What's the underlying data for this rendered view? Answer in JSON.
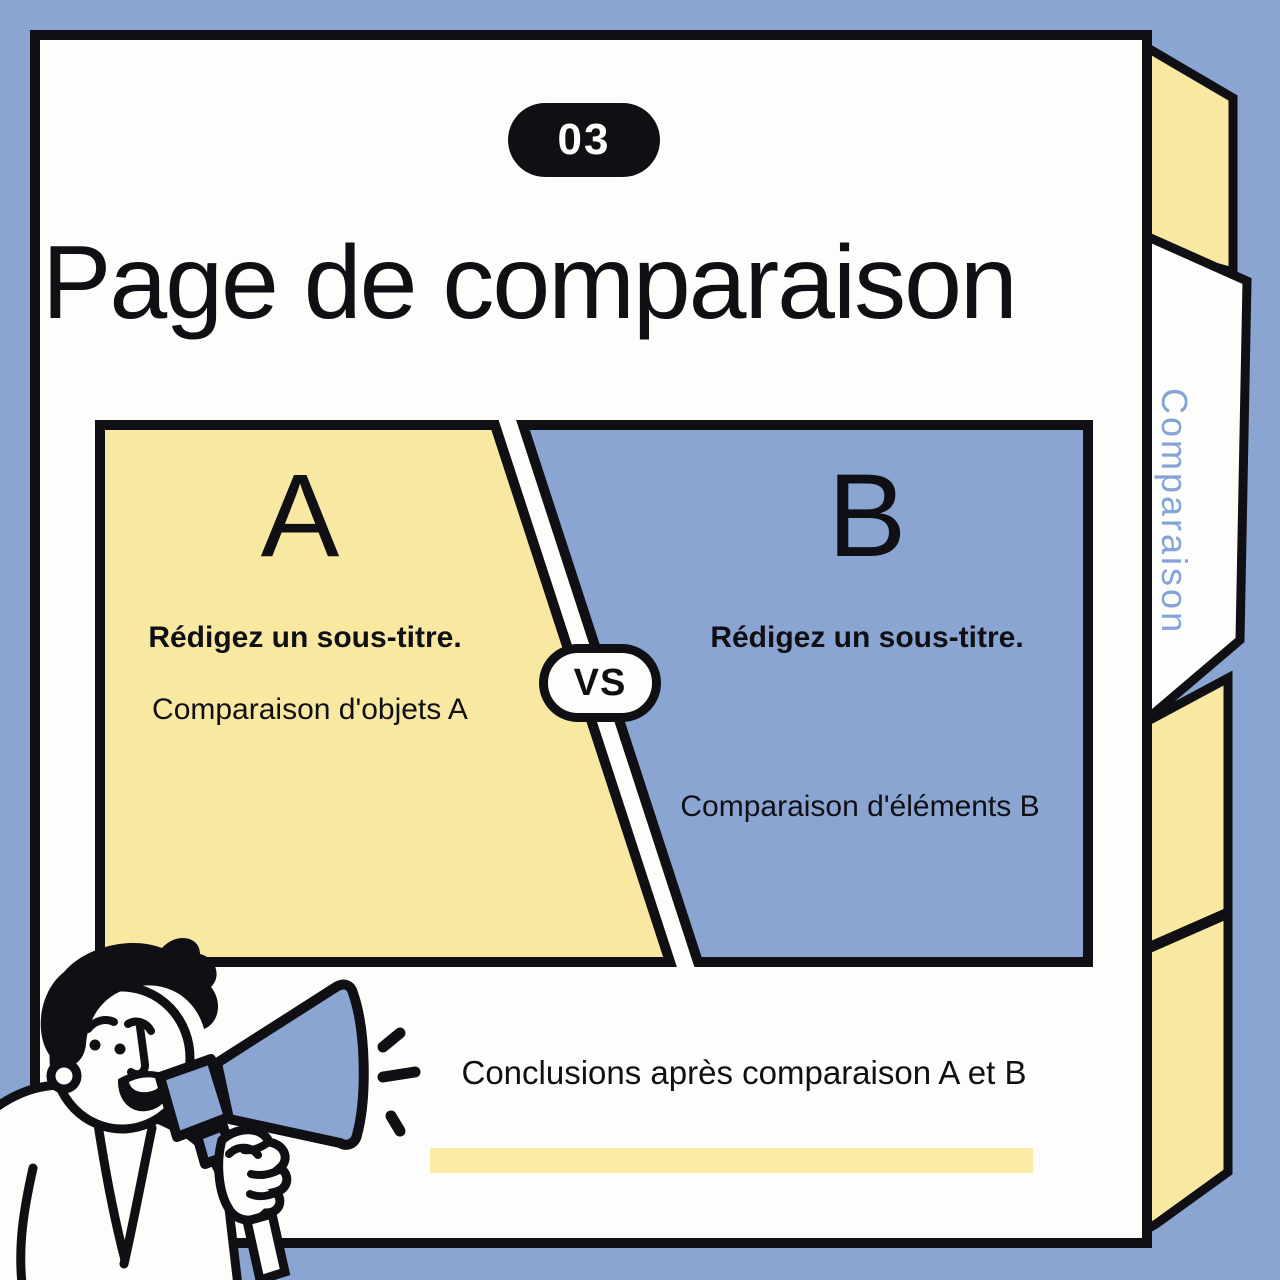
{
  "colors": {
    "background_blue": "#8ba5d2",
    "card_white": "#fdfdfb",
    "outline_black": "#101014",
    "tab_yellow": "#f9e8a2",
    "highlight_yellow": "#fbeba7",
    "panel_blue": "#8ba5d2",
    "side_tab_text_blue": "#84a3d6"
  },
  "badge": {
    "number": "03"
  },
  "title": "Page de comparaison",
  "side_tab": {
    "label": "Comparaison"
  },
  "comparison": {
    "vs_label": "VS",
    "panel_a": {
      "letter": "A",
      "subtitle": "Rédigez un sous-titre.",
      "caption": "Comparaison d'objets A"
    },
    "panel_b": {
      "letter": "B",
      "subtitle": "Rédigez un sous-titre.",
      "caption": "Comparaison d'éléments B"
    }
  },
  "conclusion": {
    "text": "Conclusions après comparaison A et B"
  },
  "illustration": {
    "name": "man-with-megaphone"
  }
}
